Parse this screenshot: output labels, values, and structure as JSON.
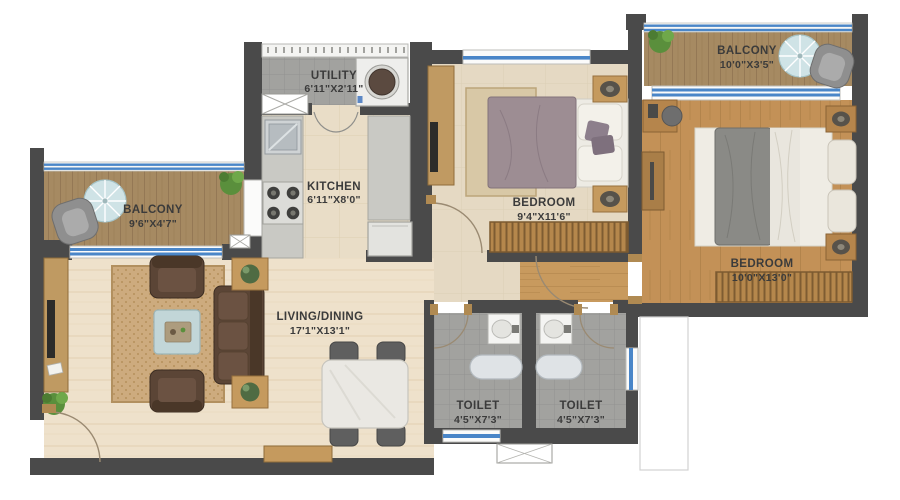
{
  "plan": {
    "type": "apartment-floor-plan",
    "rooms": {
      "utility": {
        "name": "UTILITY",
        "dims": "6'11\"X2'11\""
      },
      "kitchen": {
        "name": "KITCHEN",
        "dims": "6'11\"X8'0\""
      },
      "bedroom_1": {
        "name": "BEDROOM",
        "dims": "9'4\"X11'6\""
      },
      "balcony_right": {
        "name": "BALCONY",
        "dims": "10'0\"X3'5\""
      },
      "bedroom_2": {
        "name": "BEDROOM",
        "dims": "10'0\"X13'0\""
      },
      "balcony_left": {
        "name": "BALCONY",
        "dims": "9'6\"X4'7\""
      },
      "living_dining": {
        "name": "LIVING/DINING",
        "dims": "17'1\"X13'1\""
      },
      "toilet_1": {
        "name": "TOILET",
        "dims": "4'5\"X7'3\""
      },
      "toilet_2": {
        "name": "TOILET",
        "dims": "4'5\"X7'3\""
      }
    },
    "colors": {
      "wall": "#4a4a4a",
      "window_blue": "#4a86c8",
      "living_floor": "#eee1cb",
      "bedroom1_floor": "#e5d9c3",
      "bedroom2_wood": "#c39157",
      "balcony_wood": "#a68a62",
      "toilet_tile": "#a2a29f",
      "kitchen_floor": "#e9ddc7",
      "sofa_brown": "#5b4536",
      "rug_tan": "#cdab7e",
      "plant_green": "#5a8f3c"
    }
  }
}
